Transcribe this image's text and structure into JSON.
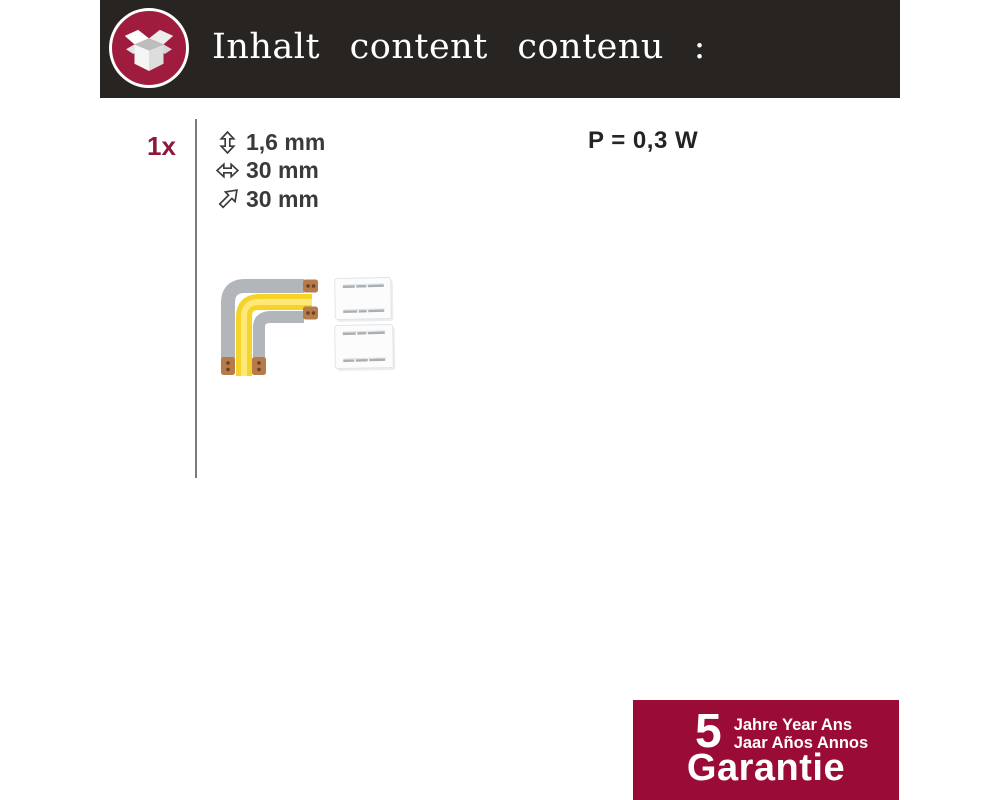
{
  "page": {
    "width": 1000,
    "height": 800,
    "background": "#ffffff"
  },
  "header": {
    "title": "Inhalt content contenu :",
    "icon": "open-box-icon",
    "bg_color": "#272422",
    "icon_circle_color": "#a01c3f"
  },
  "content": {
    "quantity": "1x",
    "specs": [
      {
        "icon": "vertical-double-arrow-icon",
        "label": "1,6 mm"
      },
      {
        "icon": "horizontal-double-arrow-icon",
        "label": "30 mm"
      },
      {
        "icon": "diagonal-arrow-icon",
        "label": "30 mm"
      }
    ],
    "power": "P = 0,3 W",
    "product": {
      "items": [
        "corner-connector",
        "mounting-clip",
        "mounting-clip"
      ],
      "colors": {
        "strip_yellow": "#f5d32a",
        "strip_gray": "#b2b6ba",
        "copper": "#b67a4b"
      }
    }
  },
  "warranty": {
    "years": "5",
    "line1": "Jahre Year Ans",
    "line2": "Jaar Años Annos",
    "label": "Garantie",
    "bg_color": "#9a0c36"
  }
}
